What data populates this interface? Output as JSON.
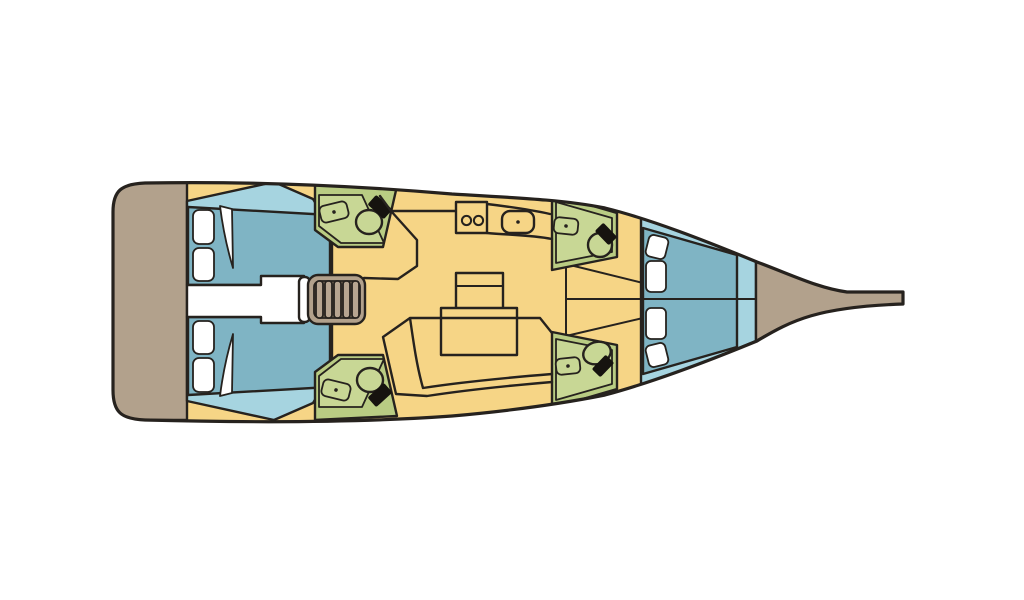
{
  "page": {
    "description": "Top-down interior layout plan of a sailing yacht, bow pointing right, stern platform on the left"
  },
  "colors": {
    "background": "#ffffff",
    "outline": "#26221e",
    "saloon_floor": "#f6d586",
    "deck": "#b2a18c",
    "steps_tread": "#b7a591",
    "steps_shadow": "#8d7d68",
    "cabin_floor": "#a6d4e0",
    "berth": "#7fb4c4",
    "head_wall": "#b9cc83",
    "head_floor": "#c8d795",
    "linen": "#ffffff",
    "toilet_tank": "#16130f"
  },
  "layout_summary": {
    "cabins": 3,
    "heads": 4,
    "toilets": 4,
    "head_sinks": 4,
    "double_berths": 3,
    "galley_burners": 2,
    "galley_sinks": 1,
    "companionway_steps": 5,
    "saloon_tables": 1
  }
}
